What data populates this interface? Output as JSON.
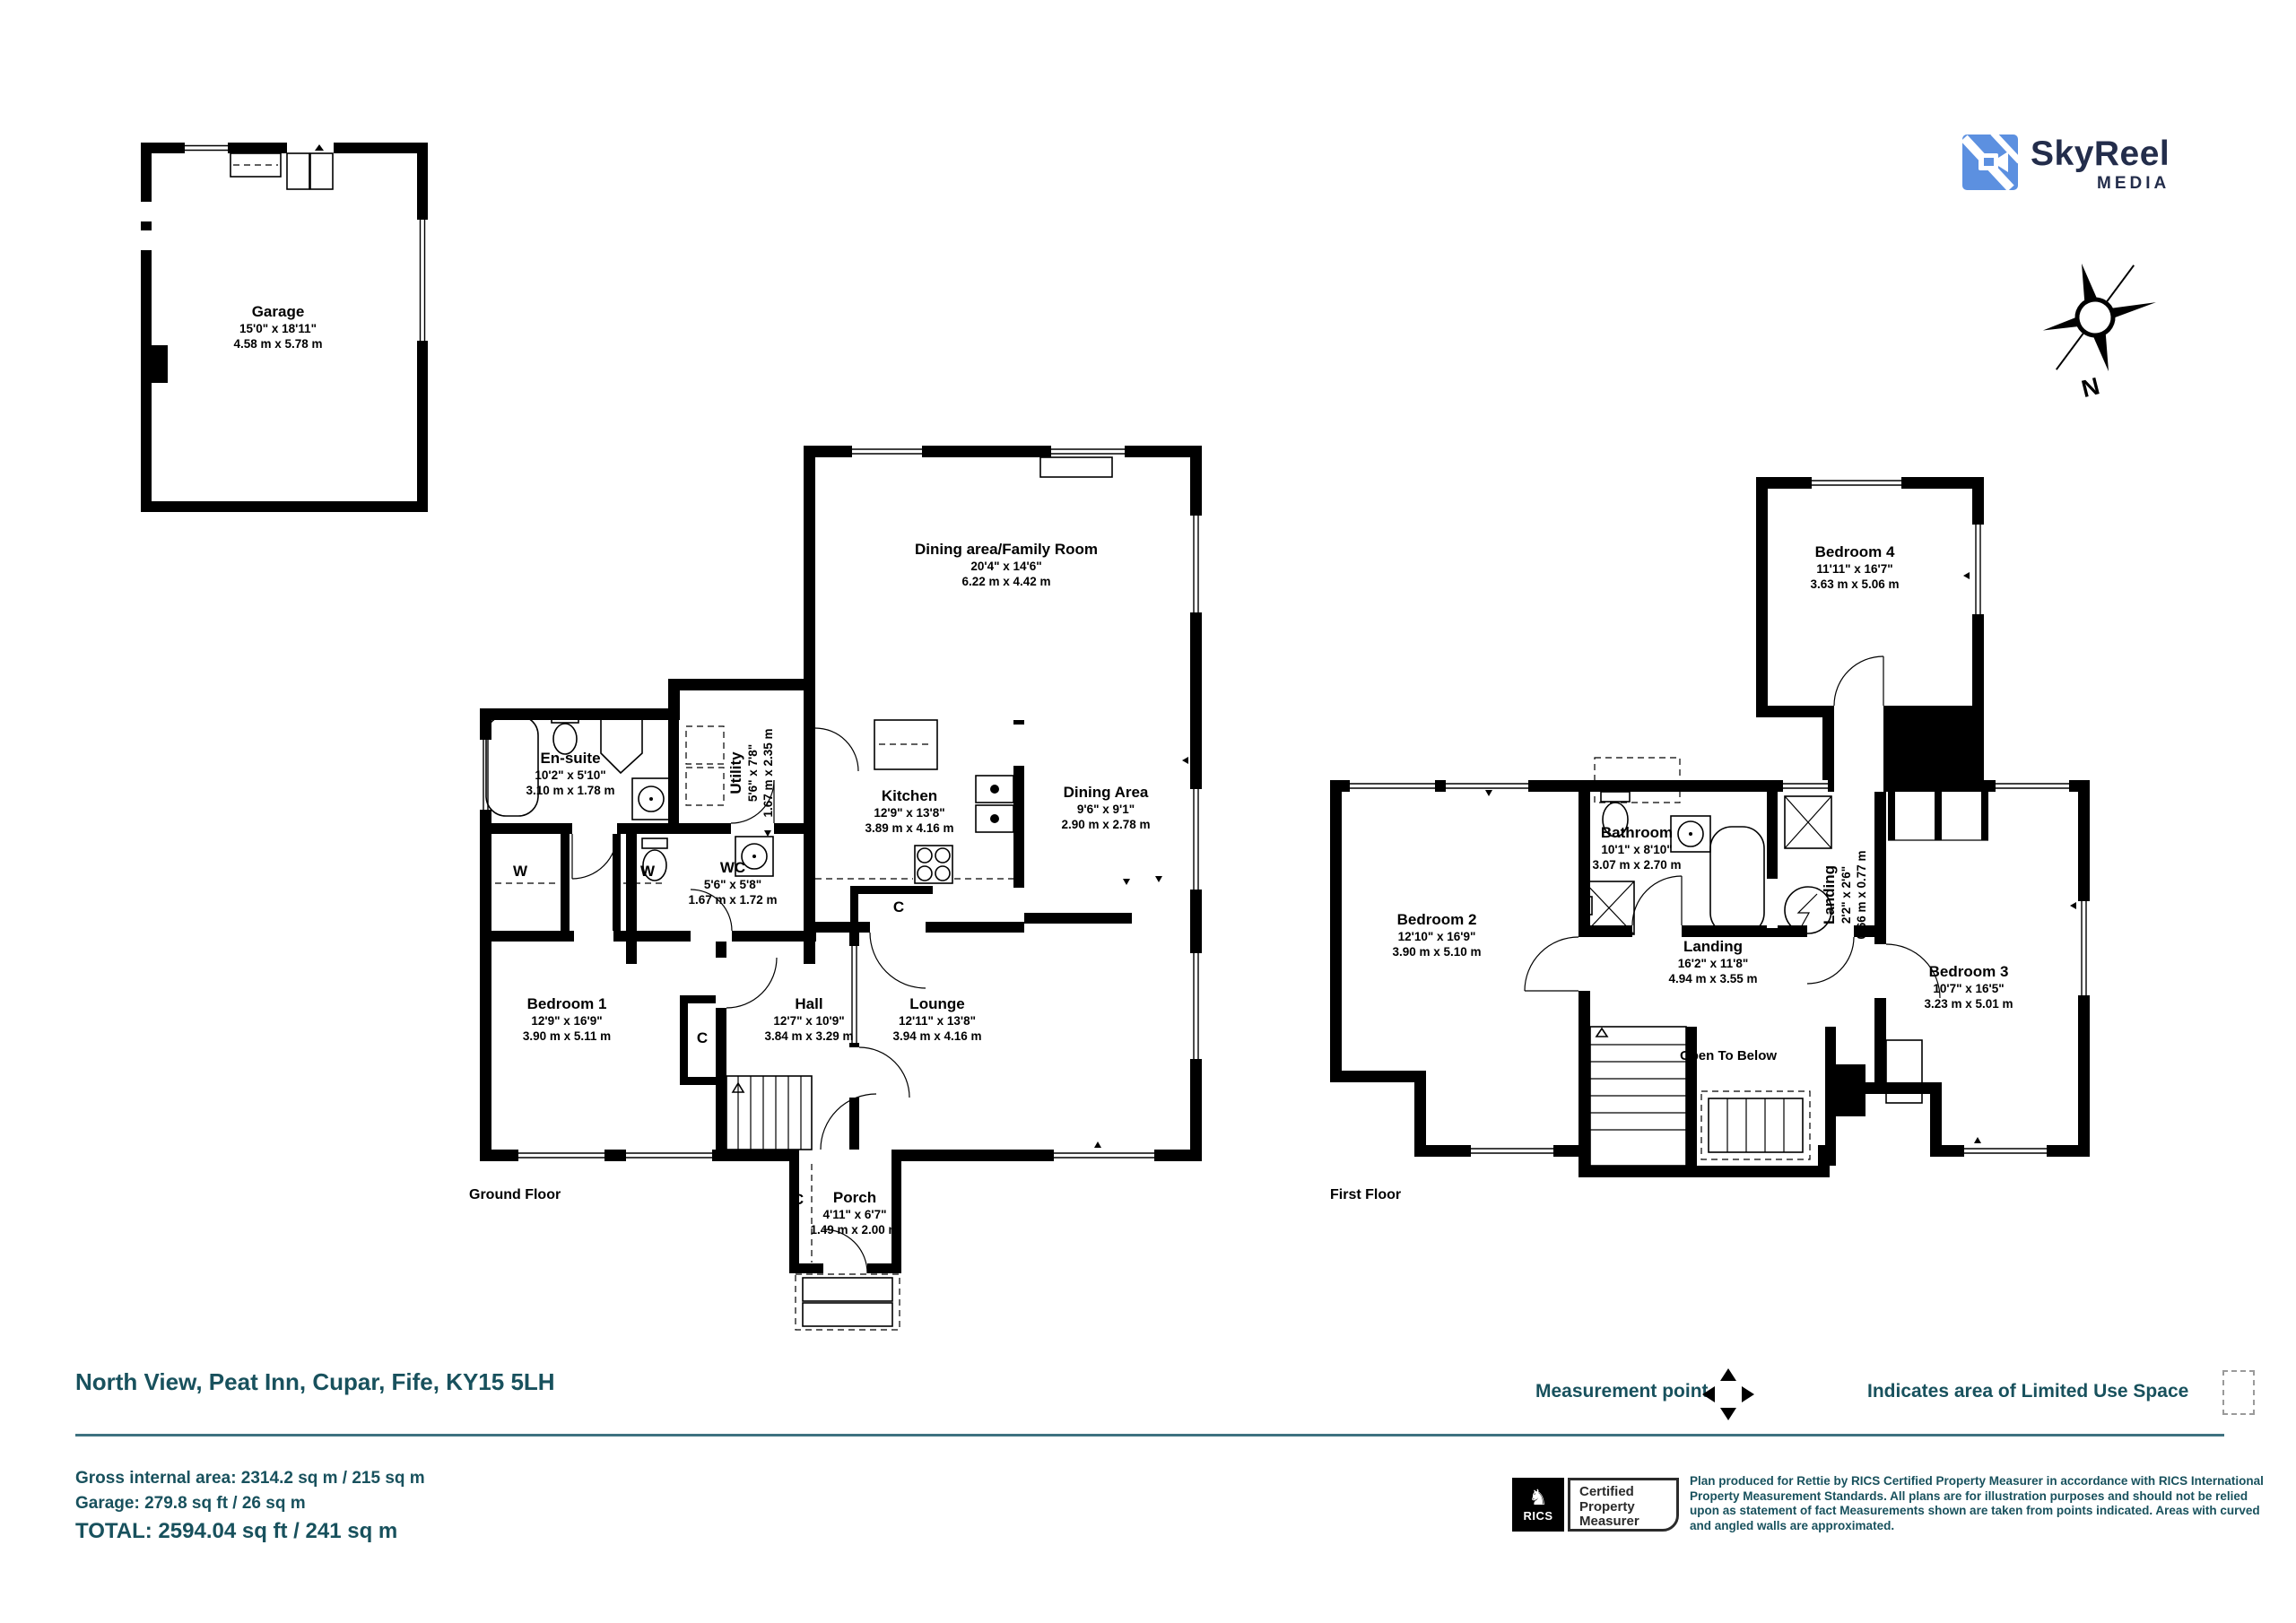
{
  "logo": {
    "brand": "SkyReel",
    "sub": "MEDIA"
  },
  "compass": {
    "n": "N"
  },
  "garage": {
    "name": "Garage",
    "imperial": "15'0\" x 18'11\"",
    "metric": "4.58 m x 5.78 m"
  },
  "annotations": {
    "wardrobe": "W",
    "cupboard": "C"
  },
  "ground": {
    "floor_label": "Ground Floor",
    "rooms": {
      "dining_family": {
        "name": "Dining area/Family Room",
        "imperial": "20'4\" x 14'6\"",
        "metric": "6.22 m x 4.42 m"
      },
      "ensuite": {
        "name": "En-suite",
        "imperial": "10'2\" x 5'10\"",
        "metric": "3.10 m x 1.78 m"
      },
      "utility": {
        "name": "Utility",
        "imperial": "5'6\" x 7'8\"",
        "metric": "1.67 m x 2.35 m"
      },
      "kitchen": {
        "name": "Kitchen",
        "imperial": "12'9\" x 13'8\"",
        "metric": "3.89 m x 4.16 m"
      },
      "dining_area": {
        "name": "Dining Area",
        "imperial": "9'6\" x 9'1\"",
        "metric": "2.90 m x 2.78 m"
      },
      "wc": {
        "name": "WC",
        "imperial": "5'6\" x 5'8\"",
        "metric": "1.67 m x 1.72 m"
      },
      "bedroom1": {
        "name": "Bedroom 1",
        "imperial": "12'9\" x 16'9\"",
        "metric": "3.90 m x 5.11 m"
      },
      "hall": {
        "name": "Hall",
        "imperial": "12'7\" x 10'9\"",
        "metric": "3.84 m x 3.29 m"
      },
      "lounge": {
        "name": "Lounge",
        "imperial": "12'11\" x 13'8\"",
        "metric": "3.94 m x 4.16 m"
      },
      "porch": {
        "name": "Porch",
        "imperial": "4'11\" x 6'7\"",
        "metric": "1.49 m x 2.00 m"
      }
    }
  },
  "first": {
    "floor_label": "First Floor",
    "rooms": {
      "bedroom4": {
        "name": "Bedroom 4",
        "imperial": "11'11\" x 16'7\"",
        "metric": "3.63 m x 5.06 m"
      },
      "bathroom": {
        "name": "Bathroom",
        "imperial": "10'1\" x 8'10\"",
        "metric": "3.07 m x 2.70 m"
      },
      "landing_small": {
        "name": "Landing",
        "imperial": "2'2\" x 2'6\"",
        "metric": "0.66 m x 0.77 m"
      },
      "bedroom2": {
        "name": "Bedroom 2",
        "imperial": "12'10\" x 16'9\"",
        "metric": "3.90 m x 5.10 m"
      },
      "landing": {
        "name": "Landing",
        "imperial": "16'2\" x 11'8\"",
        "metric": "4.94 m x 3.55 m"
      },
      "bedroom3": {
        "name": "Bedroom 3",
        "imperial": "10'7\" x 16'5\"",
        "metric": "3.23 m x 5.01 m"
      },
      "open_to_below": {
        "name": "Open To Below"
      }
    }
  },
  "footer": {
    "address": "North View, Peat Inn, Cupar, Fife, KY15 5LH",
    "gross": "Gross internal area: 2314.2 sq m / 215 sq m",
    "garage_area": "Garage: 279.8 sq ft / 26 sq m",
    "total": "TOTAL: 2594.04 sq ft / 241 sq m",
    "legend": {
      "measurement_point": "Measurement point",
      "limited_use": "Indicates area of Limited Use Space"
    },
    "rics": {
      "abbr": "RICS",
      "certified": [
        "Certified",
        "Property",
        "Measurer"
      ]
    },
    "disclaimer": "Plan produced for Rettie by RICS Certified Property Measurer in accordance with RICS International Property Measurement Standards. All plans are for illustration purposes and should not be relied upon as statement of fact Measurements shown are taken from points indicated. Areas with curved and angled walls are approximated."
  },
  "colors": {
    "teal": "#18515D",
    "navy": "#232D4B",
    "logo_blue": "#5C90E0"
  }
}
